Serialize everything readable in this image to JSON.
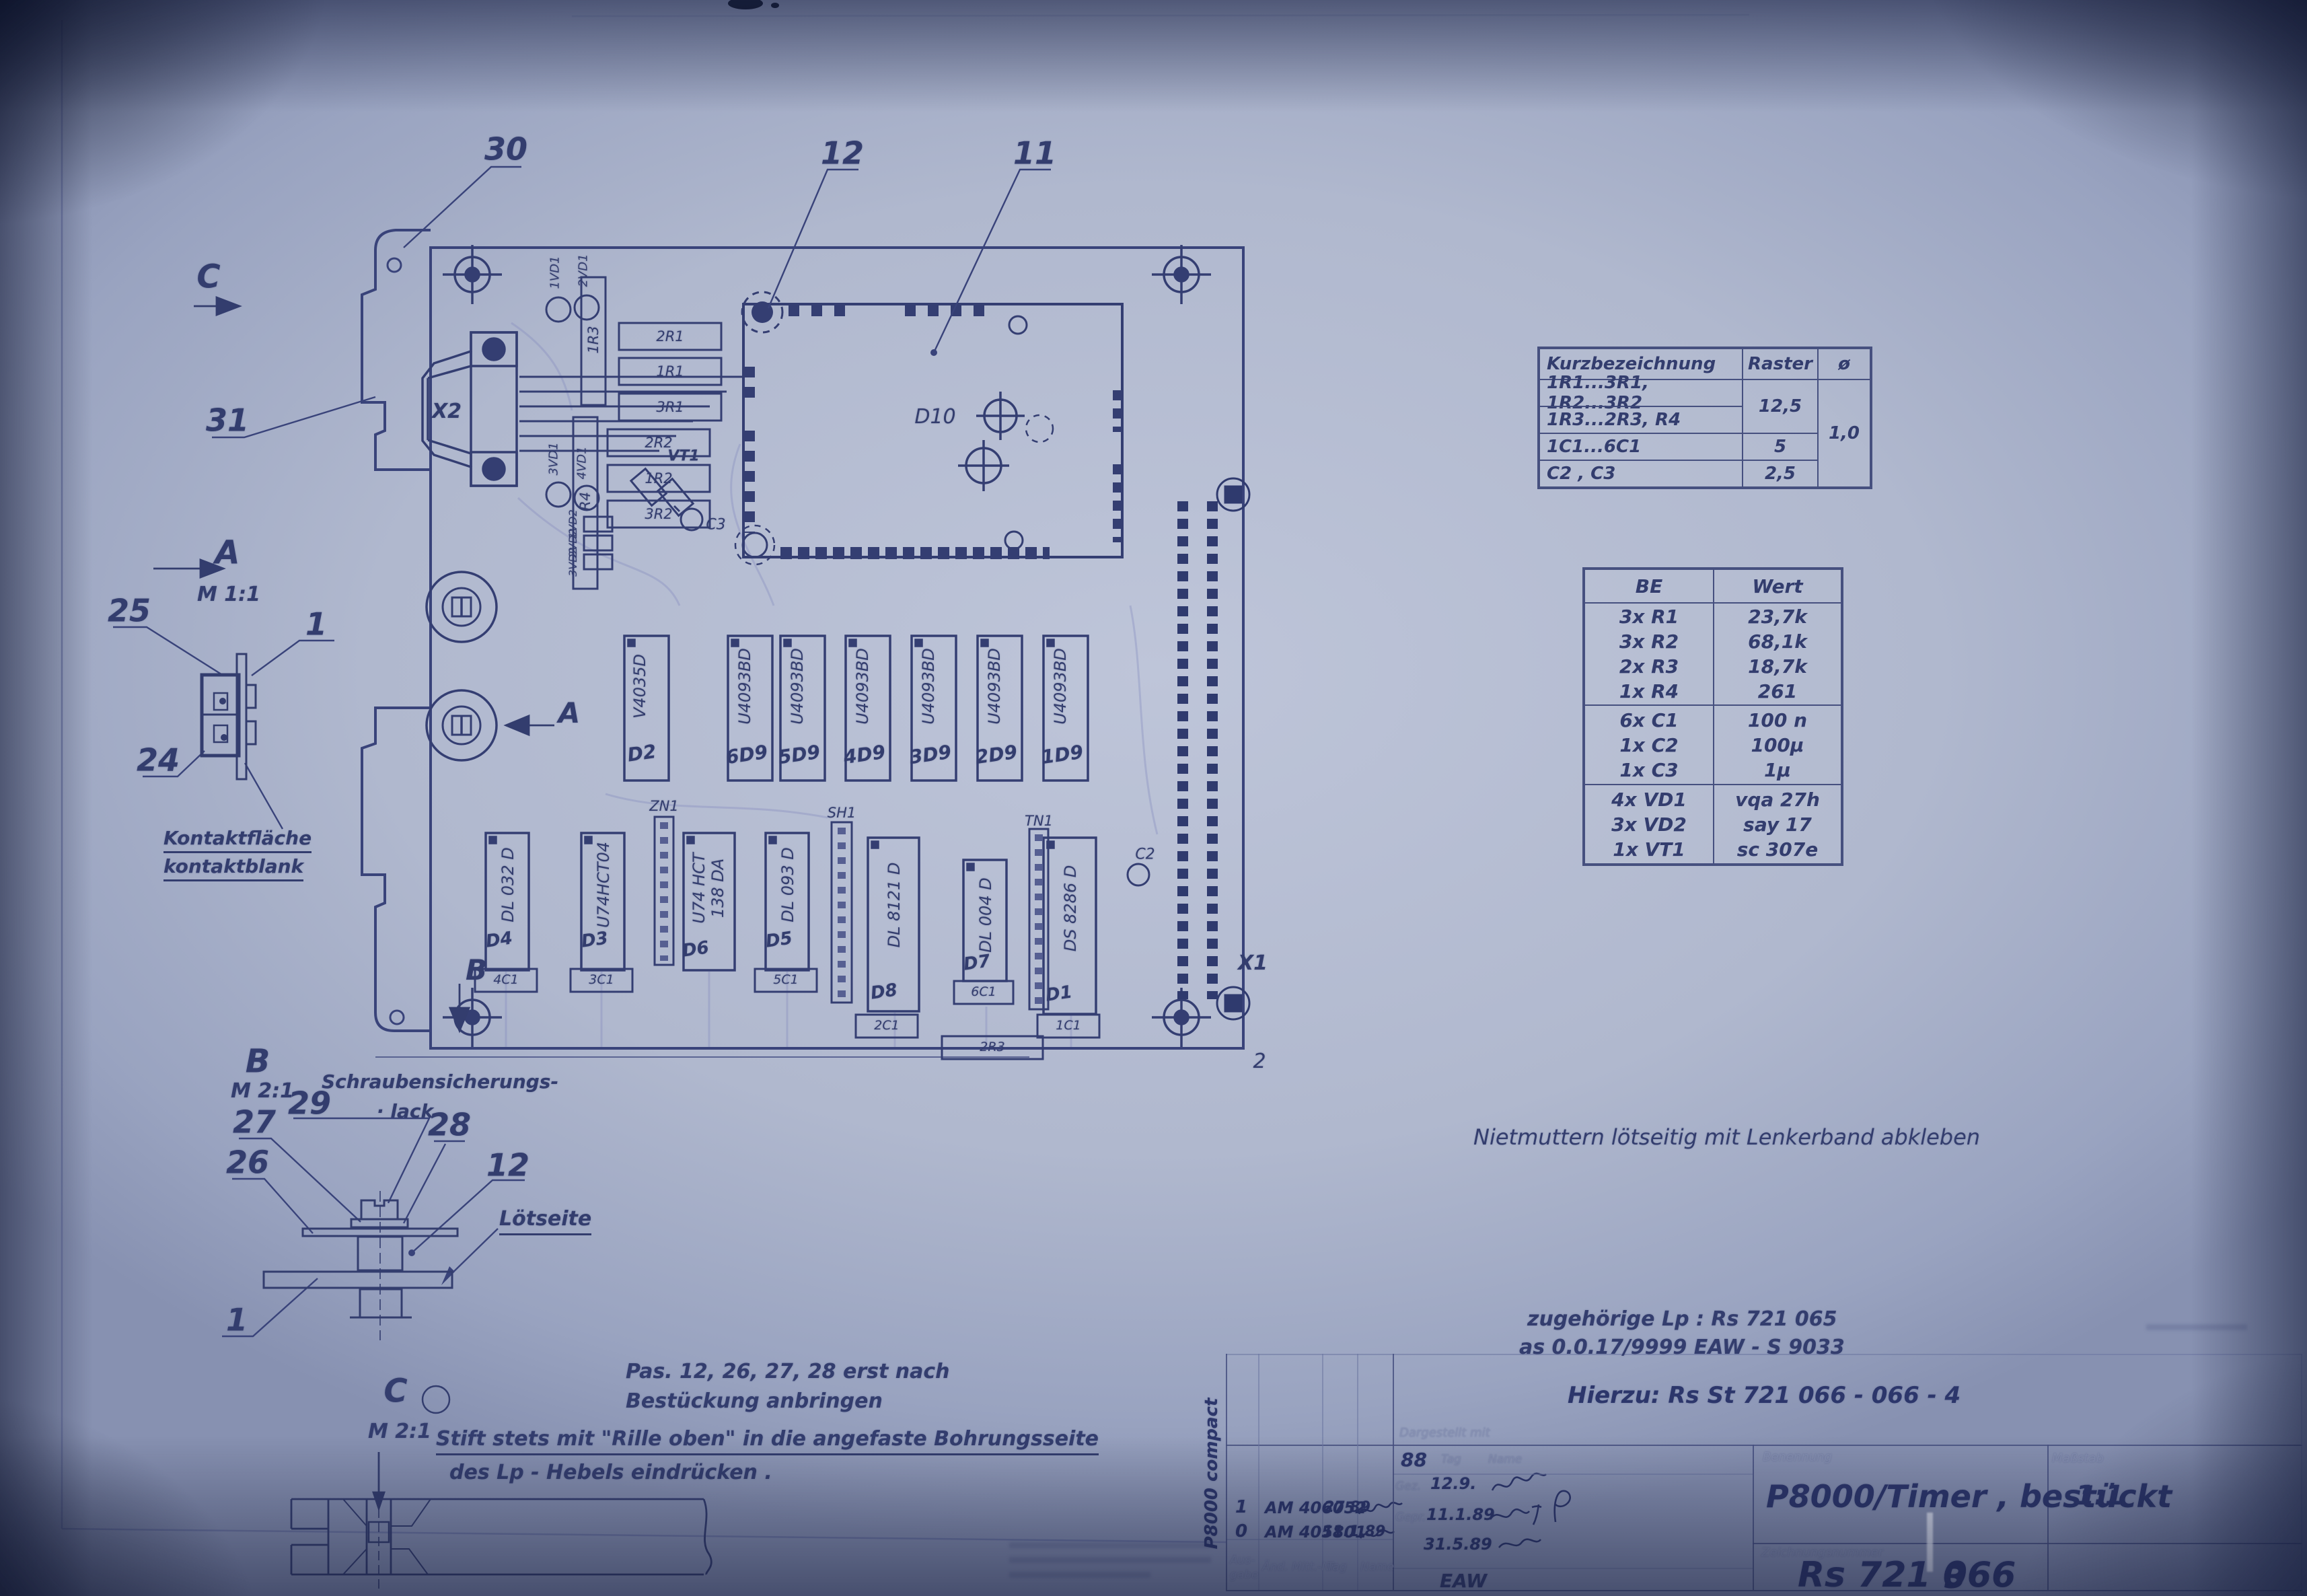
{
  "drawing": {
    "views": {
      "c": "C",
      "a": "A",
      "b": "B",
      "m11": "M 1:1",
      "m21": "M 2:1"
    },
    "callouts": {
      "n30": "30",
      "n12": "12",
      "n11": "11",
      "n31": "31",
      "n25": "25",
      "n1": "1",
      "n24": "24",
      "n29": "29",
      "n27": "27",
      "n26": "26",
      "n28": "28",
      "n12b": "12",
      "n1b": "1",
      "n2": "2"
    },
    "annotations": {
      "kontakt1": "Kontaktfläche",
      "kontakt2": "kontaktblank",
      "schraub1": "Schraubensicherungs-",
      "schraub2": "·  lack",
      "loetseite": "Lötseite"
    }
  },
  "pcb": {
    "connectors": {
      "x1": "X1",
      "x2": "X2"
    },
    "module": "D10",
    "ic_row1": [
      {
        "name": "D2",
        "part": "V4035D"
      },
      {
        "name": "6D9",
        "part": "U4093BD"
      },
      {
        "name": "5D9",
        "part": "U4093BD"
      },
      {
        "name": "4D9",
        "part": "U4093BD"
      },
      {
        "name": "3D9",
        "part": "U4093BD"
      },
      {
        "name": "2D9",
        "part": "U4093BD"
      },
      {
        "name": "1D9",
        "part": "U4093BD"
      }
    ],
    "ic_row2": [
      {
        "name": "D4",
        "part": "DL 032 D"
      },
      {
        "name": "D3",
        "part": "U74HCT04"
      },
      {
        "name": "D6",
        "part": "U74 HCT",
        "part2": "138 DA"
      },
      {
        "name": "D5",
        "part": "DL 093 D"
      },
      {
        "name": "D8",
        "part": "DL 8121 D"
      },
      {
        "name": "D7",
        "part": "DL 004 D"
      },
      {
        "name": "D1",
        "part": "DS 8286 D"
      }
    ],
    "strips": {
      "zn1": "ZN1",
      "sh1": "SH1",
      "tn1": "TN1"
    },
    "resistors": {
      "r2r1": "2R1",
      "r1r1": "1R1",
      "r3r1": "3R1",
      "r2r2": "2R2",
      "r1r2": "1R2",
      "r3r2": "3R2",
      "r1r3": "1R3",
      "r4": "R4",
      "r2r3": "2R3"
    },
    "smallcaps": {
      "c4": "4C1",
      "c3b": "3C1",
      "c5": "5C1",
      "c2b": "2C1",
      "c6": "6C1",
      "c1b": "1C1"
    },
    "diodes": {
      "vd11": "1VD1",
      "vd12": "2VD1",
      "vd13": "3VD1",
      "vd14": "4VD1",
      "vd21": "1VD2",
      "vd22": "2VD2",
      "vd23": "3VD2",
      "vt1": "VT1"
    },
    "caps": {
      "c2": "C2",
      "c3": "C3"
    }
  },
  "raster_table": {
    "col1": "Kurzbezeichnung",
    "col2": "Raster",
    "col3": "ø",
    "rows": [
      "1R1...3R1, 1R2...3R2",
      "1R3...2R3, R4",
      "1C1...6C1",
      "C2 , C3"
    ],
    "raster_a": "12,5",
    "raster_b": "5",
    "raster_c": "2,5",
    "diameter": "1,0"
  },
  "be_table": {
    "col1": "BE",
    "col2": "Wert",
    "group1": [
      {
        "be": "3x R1",
        "wert": "23,7k"
      },
      {
        "be": "3x R2",
        "wert": "68,1k"
      },
      {
        "be": "2x R3",
        "wert": "18,7k"
      },
      {
        "be": "1x R4",
        "wert": "261"
      }
    ],
    "group2": [
      {
        "be": "6x C1",
        "wert": "100 n"
      },
      {
        "be": "1x C2",
        "wert": "100µ"
      },
      {
        "be": "1x C3",
        "wert": "1µ"
      }
    ],
    "group3": [
      {
        "be": "4x VD1",
        "wert": "vqa 27h"
      },
      {
        "be": "3x VD2",
        "wert": "say 17"
      },
      {
        "be": "1x VT1",
        "wert": "sc 307e"
      }
    ]
  },
  "notes": {
    "niet": "Nietmuttern lötseitig mit Lenkerband abkleben",
    "pas1": "Pas.  12, 26, 27, 28  erst nach",
    "pas2": "Bestückung  anbringen",
    "stift1": "Stift  stets mit \"Rille oben\" in die angefaste Bohrungsseite",
    "stift2": "des Lp - Hebels eindrücken .",
    "zugeh1": "zugehörige  Lp :  Rs 721 065",
    "zugeh2": "as 0.0.17/9999   EAW - S 9033",
    "hierzu": "Hierzu:  Rs St  721 066 - 066 - 4"
  },
  "title_block": {
    "side_label": "P8000 compact",
    "revisions": [
      {
        "rev": "1",
        "doc": "AM 406052",
        "date": "27 89"
      },
      {
        "rev": "0",
        "doc": "AM 405801",
        "date": "11.1.89"
      }
    ],
    "col_ausgabe1": "Aus-",
    "col_ausgabe2": "gabe",
    "col_aend": "Änd. Mitt.-Nr.",
    "col_tag": "Tag",
    "col_name": "Name",
    "dargestellt": "Dargestellt mit",
    "year": "88",
    "hdr_tag": "Tag",
    "hdr_name": "Name",
    "row_gez": "Gez.",
    "row_gepr": "Gepr.",
    "date_gez": "12.9.",
    "date_gepr": "11.1.89",
    "date_third": "31.5.89",
    "org": "EAW",
    "benennung_label": "Benennung",
    "title": "P8000/Timer ,  bestückt",
    "massstab_label": "Maßstab",
    "massstab": "1:1",
    "zeichnung_label": "Zeichnungsnummer",
    "number": "Rs 721 066",
    "blatt": "3"
  }
}
